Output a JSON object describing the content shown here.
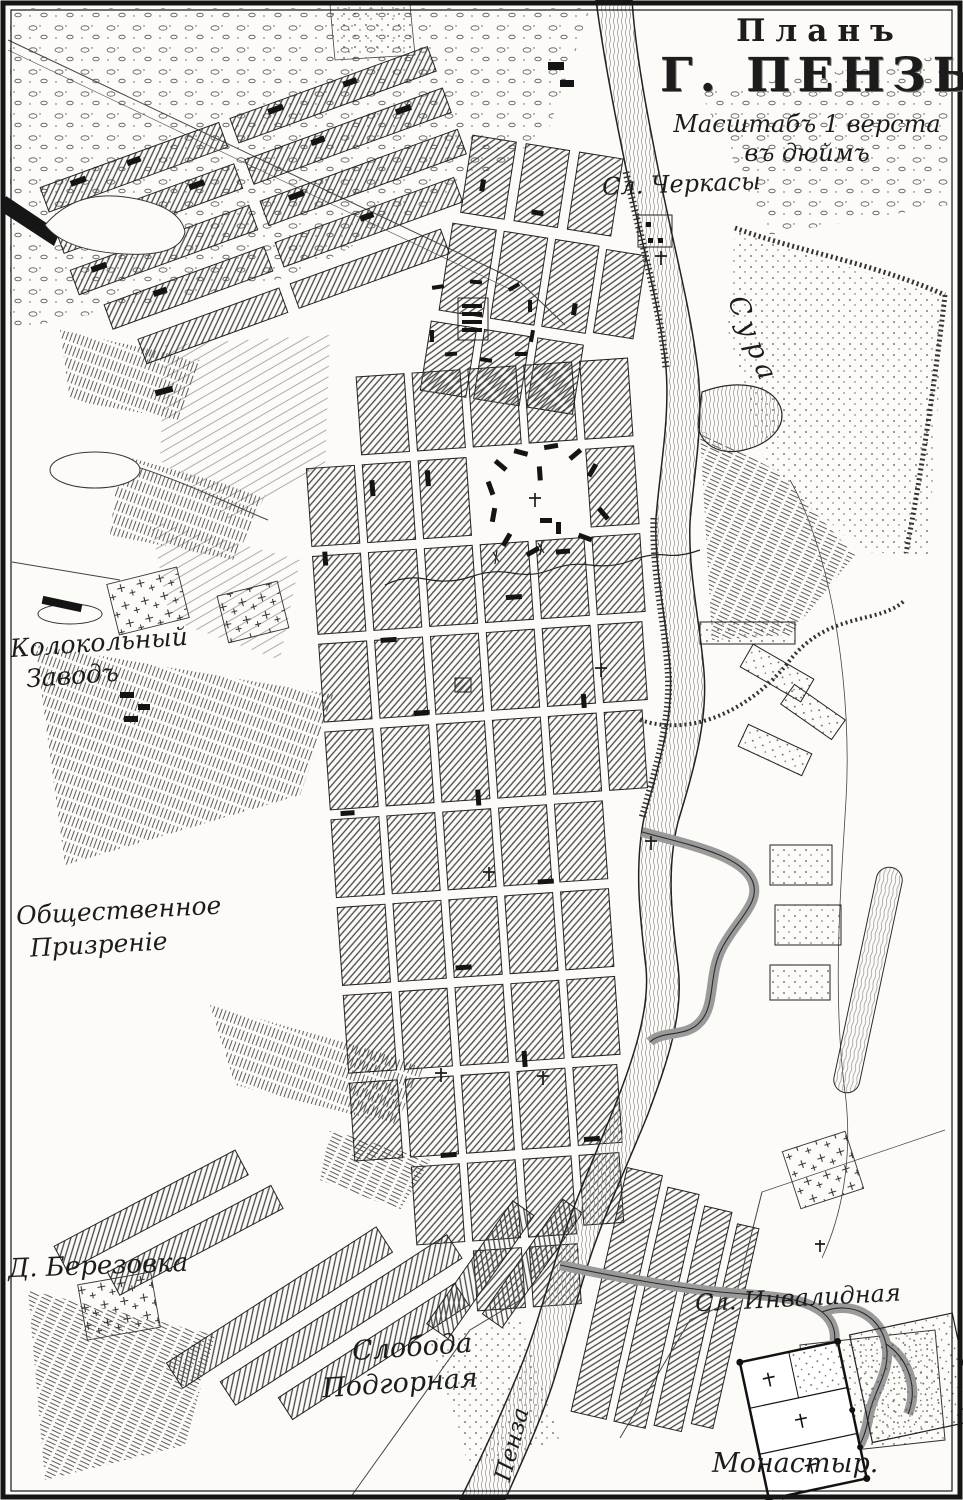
{
  "map": {
    "title": {
      "line1": "Планъ",
      "line2": "Г. ПЕНЗЫ.",
      "scale_line1": "Масштабъ 1 верста",
      "scale_line2": "въ дюймъ"
    },
    "labels": {
      "cherkasy": "Сл. Черкасы",
      "sura_river": "Сура",
      "kolokolny_line1": "Колокольный",
      "kolokolny_line2": "Заводъ",
      "prizrenie_line1": "Общественное",
      "prizrenie_line2": "Призреніе",
      "berezovka": "Д. Березовка",
      "podgornaya_line1": "Слобода",
      "podgornaya_line2": "Подгорная",
      "invalidnaya": "Сл. Инвалидная",
      "monastyr": "Монастыр.",
      "penza_river": "Пенза"
    },
    "colors": {
      "paper": "#fcfbf8",
      "ink": "#1e1e1e",
      "hatch": "#454545",
      "water_line": "#8d8d8d"
    }
  }
}
